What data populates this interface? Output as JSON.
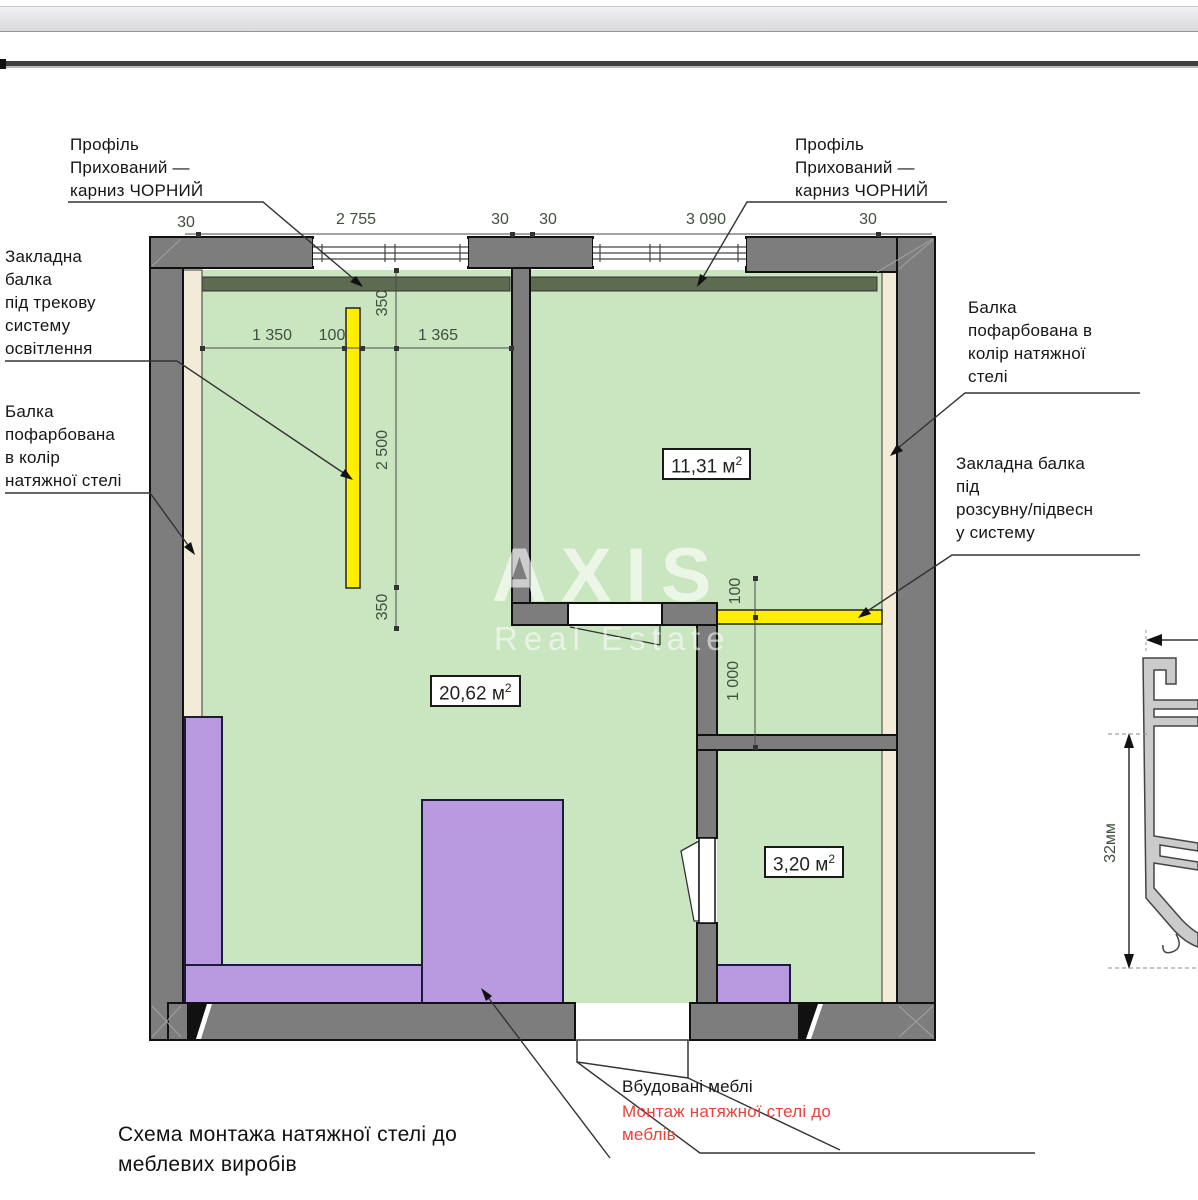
{
  "annotations": {
    "profile_left": [
      "Профіль",
      "Прихований —",
      "карниз ЧОРНИЙ"
    ],
    "profile_right": [
      "Профіль",
      "Прихований —",
      "карниз ЧОРНИЙ"
    ],
    "track_beam": [
      "Закладна",
      "балка",
      "під трекову",
      "систему",
      "освітлення"
    ],
    "painted_beam_left": [
      "Балка",
      "пофарбована",
      "в колір",
      "натяжної стелі"
    ],
    "painted_beam_right": [
      "Балка",
      "пофарбована в",
      "колір натяжної",
      "стелі"
    ],
    "sliding_beam_right": [
      "Закладна балка",
      "під",
      "розсувну/підвесн",
      "у систему"
    ],
    "builtin_furniture": "Вбудовані меблі",
    "mount_note": [
      "Монтаж натяжної стелі до",
      "меблів"
    ],
    "caption": [
      "Схема монтажа натяжної стелі до",
      "меблевих виробів"
    ]
  },
  "dimensions": {
    "top": [
      "30",
      "2 755",
      "30",
      "30",
      "3 090",
      "30"
    ],
    "room1_h": [
      "1 350",
      "100",
      "1 365"
    ],
    "room1_v": [
      "350",
      "2 500",
      "350"
    ],
    "right_v": [
      "100",
      "1 000"
    ],
    "detail": "32мм"
  },
  "rooms": [
    {
      "name": "living",
      "area": "20,62 м",
      "sup": "2"
    },
    {
      "name": "bedroom",
      "area": "11,31 м",
      "sup": "2"
    },
    {
      "name": "bathroom",
      "area": "3,20 м",
      "sup": "2"
    }
  ],
  "watermark": {
    "line1": "AXIS",
    "line2": "Real Estate"
  },
  "colors": {
    "room_fill": "#cae6c0",
    "wall": "#7d7d7d",
    "beam_yellow": "#ffee00",
    "furniture_purple": "#b99ae0",
    "cornice_green": "#5d6b50",
    "beige_finish": "#f2ebd8",
    "note_red": "#e8433a"
  }
}
